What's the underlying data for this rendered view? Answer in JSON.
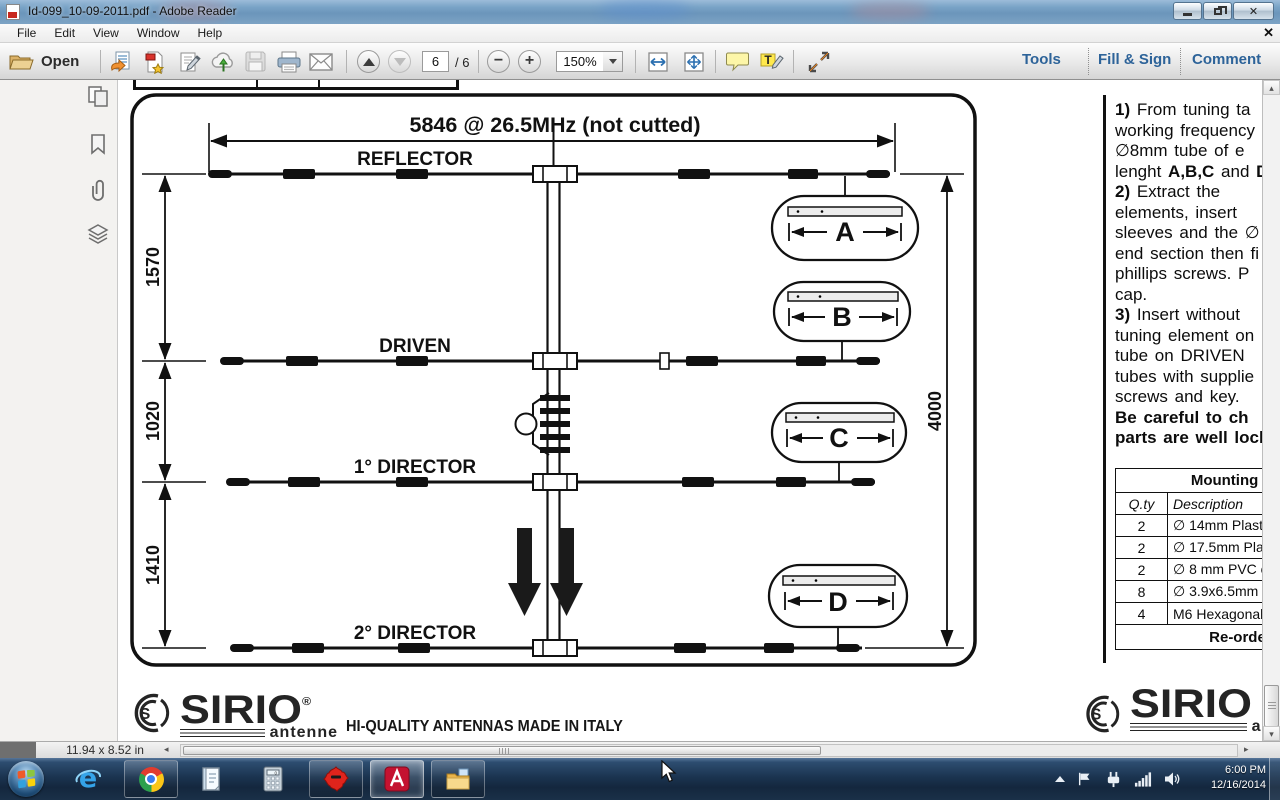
{
  "window": {
    "title": "Id-099_10-09-2011.pdf - Adobe Reader"
  },
  "menu": {
    "items": [
      "File",
      "Edit",
      "View",
      "Window",
      "Help"
    ],
    "close_icon": "✕"
  },
  "toolbar": {
    "open_label": "Open",
    "page_current": "6",
    "page_total": "/ 6",
    "zoom_value": "150%",
    "tools_label": "Tools",
    "fill_sign_label": "Fill & Sign",
    "comment_label": "Comment"
  },
  "diagram": {
    "top_dimension": "5846 @ 26.5MHz (not cutted)",
    "reflector_label": "REFLECTOR",
    "driven_label": "DRIVEN",
    "director1_label": "1° DIRECTOR",
    "director2_label": "2° DIRECTOR",
    "dim_reflector_driven": "1570",
    "dim_driven_director1": "1020",
    "dim_director1_director2": "1410",
    "dim_boom": "4000",
    "callout_a": "A",
    "callout_b": "B",
    "callout_c": "C",
    "callout_d": "D"
  },
  "instructions": {
    "lines": [
      [
        {
          "t": "1) ",
          "b": true
        },
        {
          "t": "From tuning ta",
          "b": false
        }
      ],
      [
        {
          "t": "working frequency",
          "b": false
        }
      ],
      [
        {
          "t": "∅8mm tube of e",
          "b": false
        }
      ],
      [
        {
          "t": "lenght ",
          "b": false
        },
        {
          "t": "A,B,C",
          "b": true
        },
        {
          "t": " and ",
          "b": false
        },
        {
          "t": "D",
          "b": true
        }
      ],
      [
        {
          "t": "2) ",
          "b": true
        },
        {
          "t": "Extract the",
          "b": false
        }
      ],
      [
        {
          "t": "elements,  insert",
          "b": false
        }
      ],
      [
        {
          "t": "sleeves and the ∅",
          "b": false
        }
      ],
      [
        {
          "t": "end section then fi",
          "b": false
        }
      ],
      [
        {
          "t": "phillips screws. P",
          "b": false
        }
      ],
      [
        {
          "t": "cap.",
          "b": false
        }
      ],
      [
        {
          "t": "3) ",
          "b": true
        },
        {
          "t": "Insert without",
          "b": false
        }
      ],
      [
        {
          "t": "tuning element on",
          "b": false
        }
      ],
      [
        {
          "t": "tube on DRIVEN",
          "b": false
        }
      ],
      [
        {
          "t": "tubes with supplie",
          "b": false
        }
      ],
      [
        {
          "t": "screws and key.",
          "b": false
        }
      ],
      [
        {
          "t": "Be careful to ch",
          "b": true
        }
      ],
      [
        {
          "t": "parts are well lock",
          "b": true
        }
      ]
    ]
  },
  "table": {
    "title": "Mounting Elements",
    "col_qty": "Q.ty",
    "col_desc": "Description",
    "rows": [
      [
        "2",
        "∅ 14mm Plastic"
      ],
      [
        "2",
        "∅ 17.5mm Plast"
      ],
      [
        "2",
        "∅ 8 mm PVC ca"
      ],
      [
        "8",
        "∅ 3.9x6.5mm p"
      ],
      [
        "4",
        "M6 Hexagonal n"
      ]
    ],
    "footer": "Re-order code"
  },
  "brand": {
    "name": "SIRIO",
    "reg": "®",
    "sub": "antenne",
    "tagline": "HI-QUALITY ANTENNAS MADE IN ITALY"
  },
  "statusbar": {
    "page_size": "11.94 x 8.52 in"
  },
  "taskbar": {
    "time": "6:00 PM",
    "date": "12/16/2014"
  }
}
